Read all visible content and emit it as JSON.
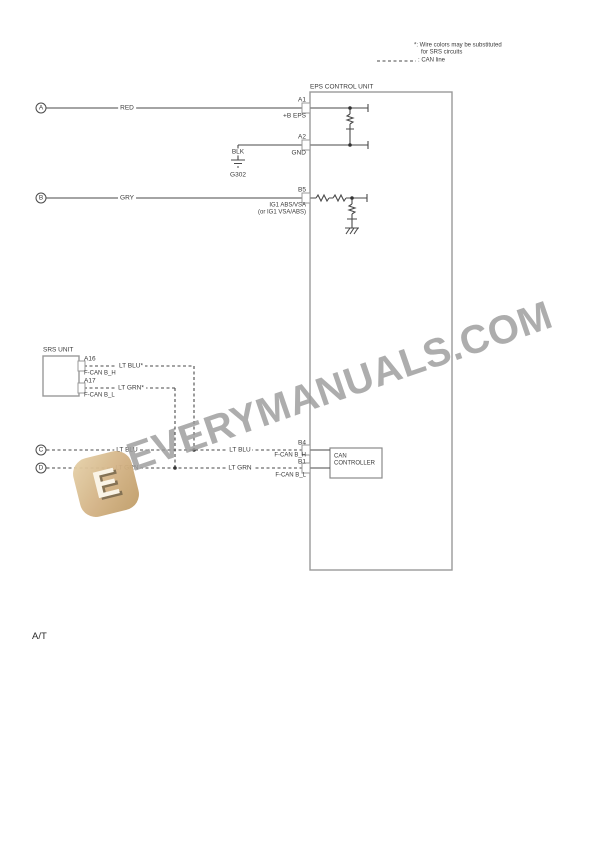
{
  "legend": {
    "note_line1": "*: Wire colors may be substituted",
    "note_line2": "for SRS circuits",
    "can_line_label": ": CAN line"
  },
  "eps_unit": {
    "title": "EPS CONTROL UNIT",
    "terminal_a1": "A1",
    "pin_a1": "+B EPS",
    "terminal_a2": "A2",
    "pin_a2": "GND",
    "terminal_b5": "B5",
    "pin_b5_line1": "IG1 ABS/VSA",
    "pin_b5_line2": "(or IG1 VSA/ABS)",
    "terminal_b4": "B4",
    "pin_b4": "F-CAN B_H",
    "terminal_b1": "B1",
    "pin_b1": "F-CAN B_L",
    "can_controller_line1": "CAN",
    "can_controller_line2": "CONTROLLER"
  },
  "srs_unit": {
    "title": "SRS UNIT",
    "terminal_a16": "A16",
    "wire_a16": "LT BLU*",
    "pin_a16": "F-CAN B_H",
    "terminal_a17": "A17",
    "wire_a17": "LT GRN*",
    "pin_a17": "F-CAN B_L"
  },
  "connectors": {
    "a": "A",
    "b": "B",
    "c": "C",
    "d": "D"
  },
  "wires": {
    "red": "RED",
    "gry": "GRY",
    "blk": "BLK",
    "lt_blu": "LT BLU",
    "lt_grn": "LT GRN"
  },
  "ground": {
    "g302": "G302"
  },
  "watermark": {
    "text": "EVERYMANUALS.COM",
    "logo_letter": "E"
  },
  "footer": {
    "label": "A/T"
  },
  "colors": {
    "wire_line": "#4a4a4a",
    "box_border": "#999999",
    "watermark_text": "#9c9c9c",
    "logo_gold": "#d2b183"
  }
}
